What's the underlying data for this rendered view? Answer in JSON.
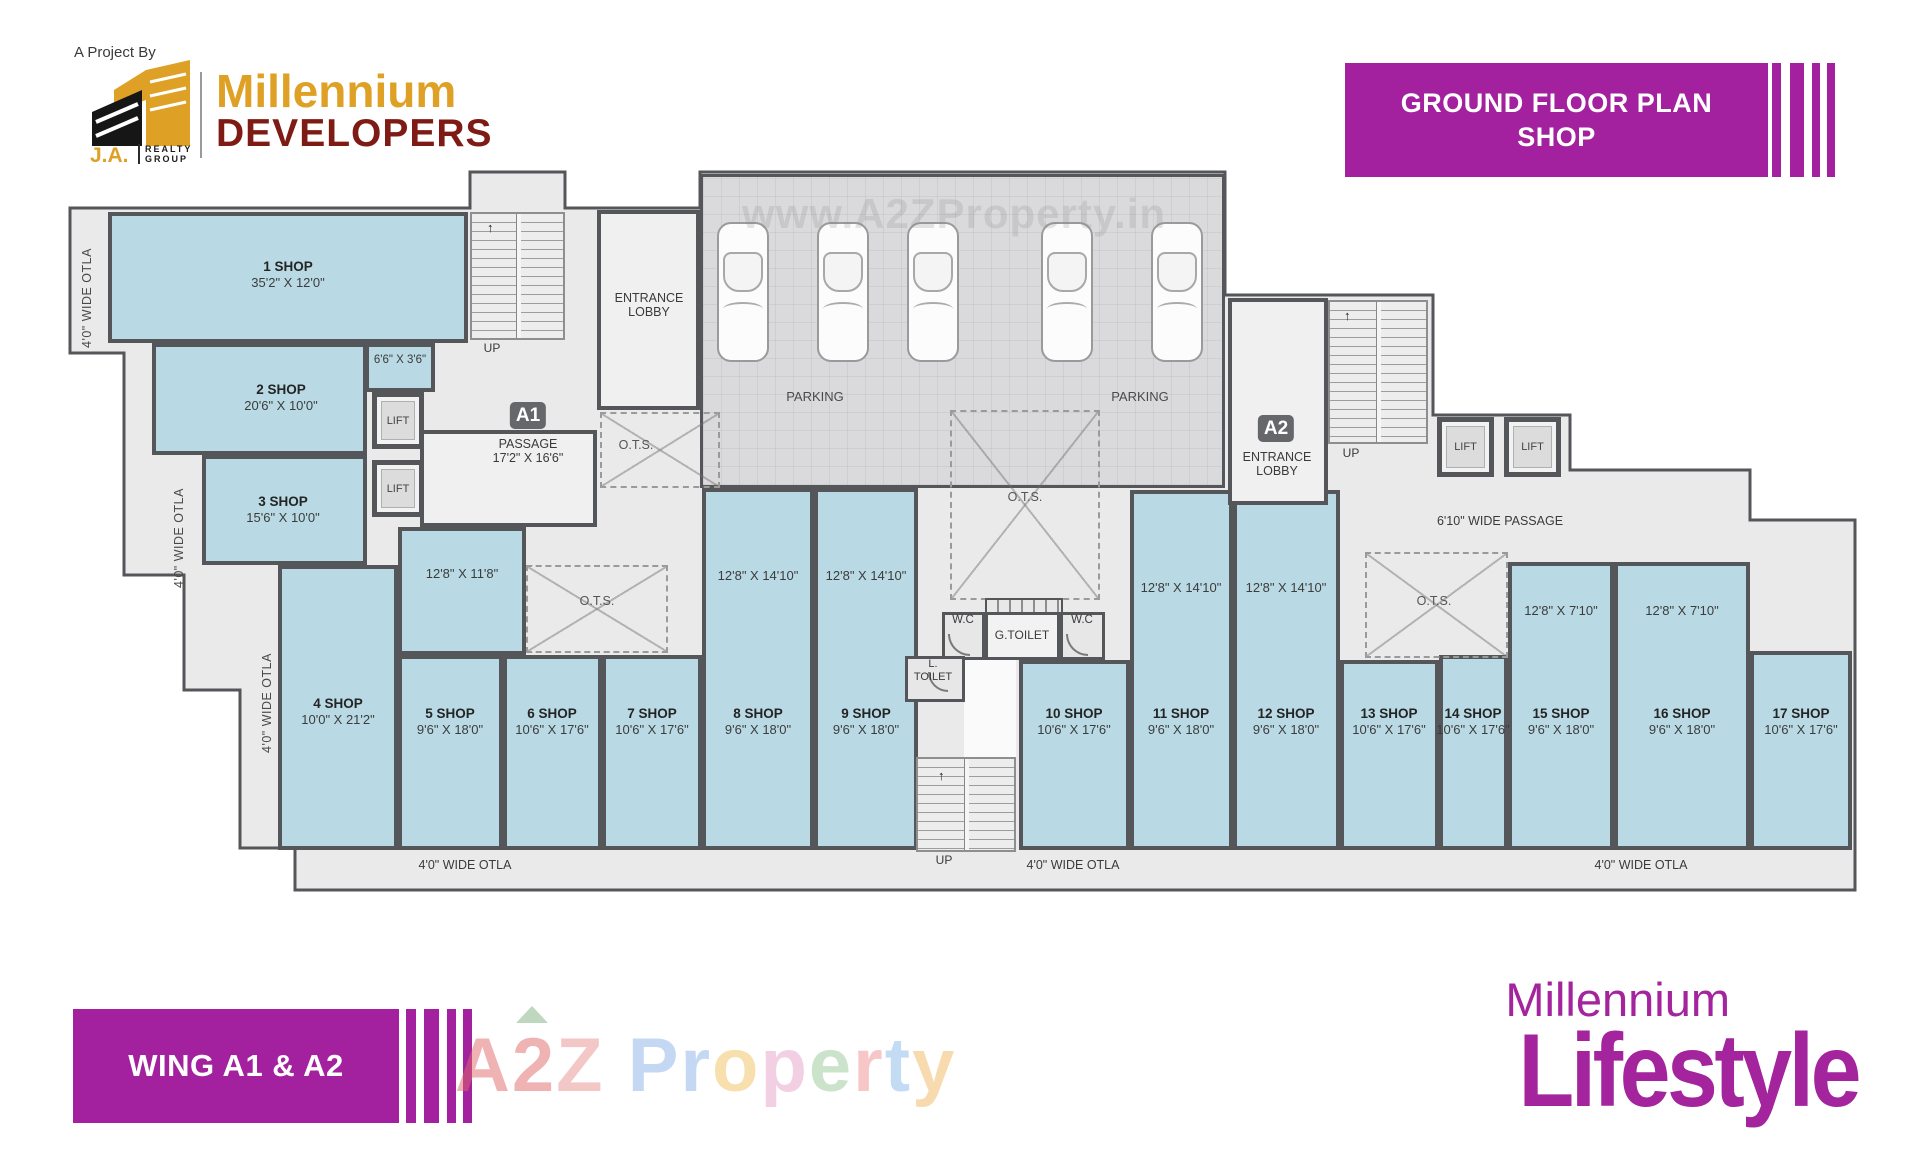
{
  "header": {
    "project_by": "A Project By",
    "logo": {
      "initials": "J.A.",
      "realty": "REALTY",
      "group": "GROUP"
    },
    "brand_top": "Millennium",
    "brand_bottom": "DEVELOPERS",
    "banner_line1": "GROUND FLOOR PLAN",
    "banner_line2": "SHOP"
  },
  "plan": {
    "shops": [
      {
        "name": "1 SHOP",
        "size": "35'2\" X 12'0\""
      },
      {
        "name": "2 SHOP",
        "size": "20'6\" X 10'0\"",
        "annex": "6'6\" X 3'6\""
      },
      {
        "name": "3 SHOP",
        "size": "15'6\" X 10'0\""
      },
      {
        "name": "4 SHOP",
        "size": "10'0\" X 21'2\""
      },
      {
        "name": "5 SHOP",
        "size": "9'6\" X 18'0\"",
        "upper": "12'8\" X 11'8\""
      },
      {
        "name": "6 SHOP",
        "size": "10'6\" X 17'6\""
      },
      {
        "name": "7 SHOP",
        "size": "10'6\" X 17'6\""
      },
      {
        "name": "8 SHOP",
        "size": "9'6\" X 18'0\"",
        "upper": "12'8\" X 14'10\""
      },
      {
        "name": "9 SHOP",
        "size": "9'6\" X 18'0\"",
        "upper": "12'8\" X 14'10\""
      },
      {
        "name": "10 SHOP",
        "size": "10'6\" X 17'6\""
      },
      {
        "name": "11 SHOP",
        "size": "9'6\" X 18'0\"",
        "upper": "12'8\" X 14'10\""
      },
      {
        "name": "12 SHOP",
        "size": "9'6\" X 18'0\"",
        "upper": "12'8\" X 14'10\""
      },
      {
        "name": "13 SHOP",
        "size": "10'6\" X 17'6\""
      },
      {
        "name": "14 SHOP",
        "size": "10'6\" X 17'6\""
      },
      {
        "name": "15 SHOP",
        "size": "9'6\" X 18'0\"",
        "upper": "12'8\" X 7'10\""
      },
      {
        "name": "16 SHOP",
        "size": "9'6\" X 18'0\"",
        "upper": "12'8\" X 7'10\""
      },
      {
        "name": "17 SHOP",
        "size": "10'6\" X 17'6\""
      }
    ],
    "labels": {
      "entrance": "ENTRANCE",
      "lobby": "LOBBY",
      "a1": "A1",
      "a2": "A2",
      "passage": "PASSAGE",
      "passage_size": "17'2\" X 16'6\"",
      "wide_passage": "6'10\" WIDE PASSAGE",
      "parking": "PARKING",
      "ots": "O.T.S.",
      "lift": "LIFT",
      "up": "UP",
      "wc": "W.C",
      "g_toilet": "G.TOILET",
      "l_toilet_line1": "L.",
      "l_toilet_line2": "TOILET",
      "otla": "4'0\" WIDE OTLA"
    }
  },
  "footer": {
    "wing": "WING A1 & A2",
    "brand_line1": "Millennium",
    "brand_line2": "Lifestyle"
  },
  "watermarks": {
    "top": "www.A2ZProperty.in",
    "bottom_letters": [
      {
        "ch": "A",
        "color": "#e06a6a"
      },
      {
        "ch": "2",
        "color": "#e06a6a"
      },
      {
        "ch": "Z",
        "color": "#e8908f"
      },
      {
        "ch": " ",
        "color": "#000000"
      },
      {
        "ch": "P",
        "color": "#8db3e8"
      },
      {
        "ch": "r",
        "color": "#8db3e8"
      },
      {
        "ch": "o",
        "color": "#f0c060"
      },
      {
        "ch": "p",
        "color": "#e8a0c8"
      },
      {
        "ch": "e",
        "color": "#98c898"
      },
      {
        "ch": "r",
        "color": "#f09090"
      },
      {
        "ch": "t",
        "color": "#88b8e8"
      },
      {
        "ch": "y",
        "color": "#f0b860"
      }
    ]
  },
  "colors": {
    "magenta": "#A3219E",
    "gold": "#DFA125",
    "dark_red": "#7E1B15",
    "shop_fill": "#B9DAE5",
    "wall": "#54565A"
  }
}
